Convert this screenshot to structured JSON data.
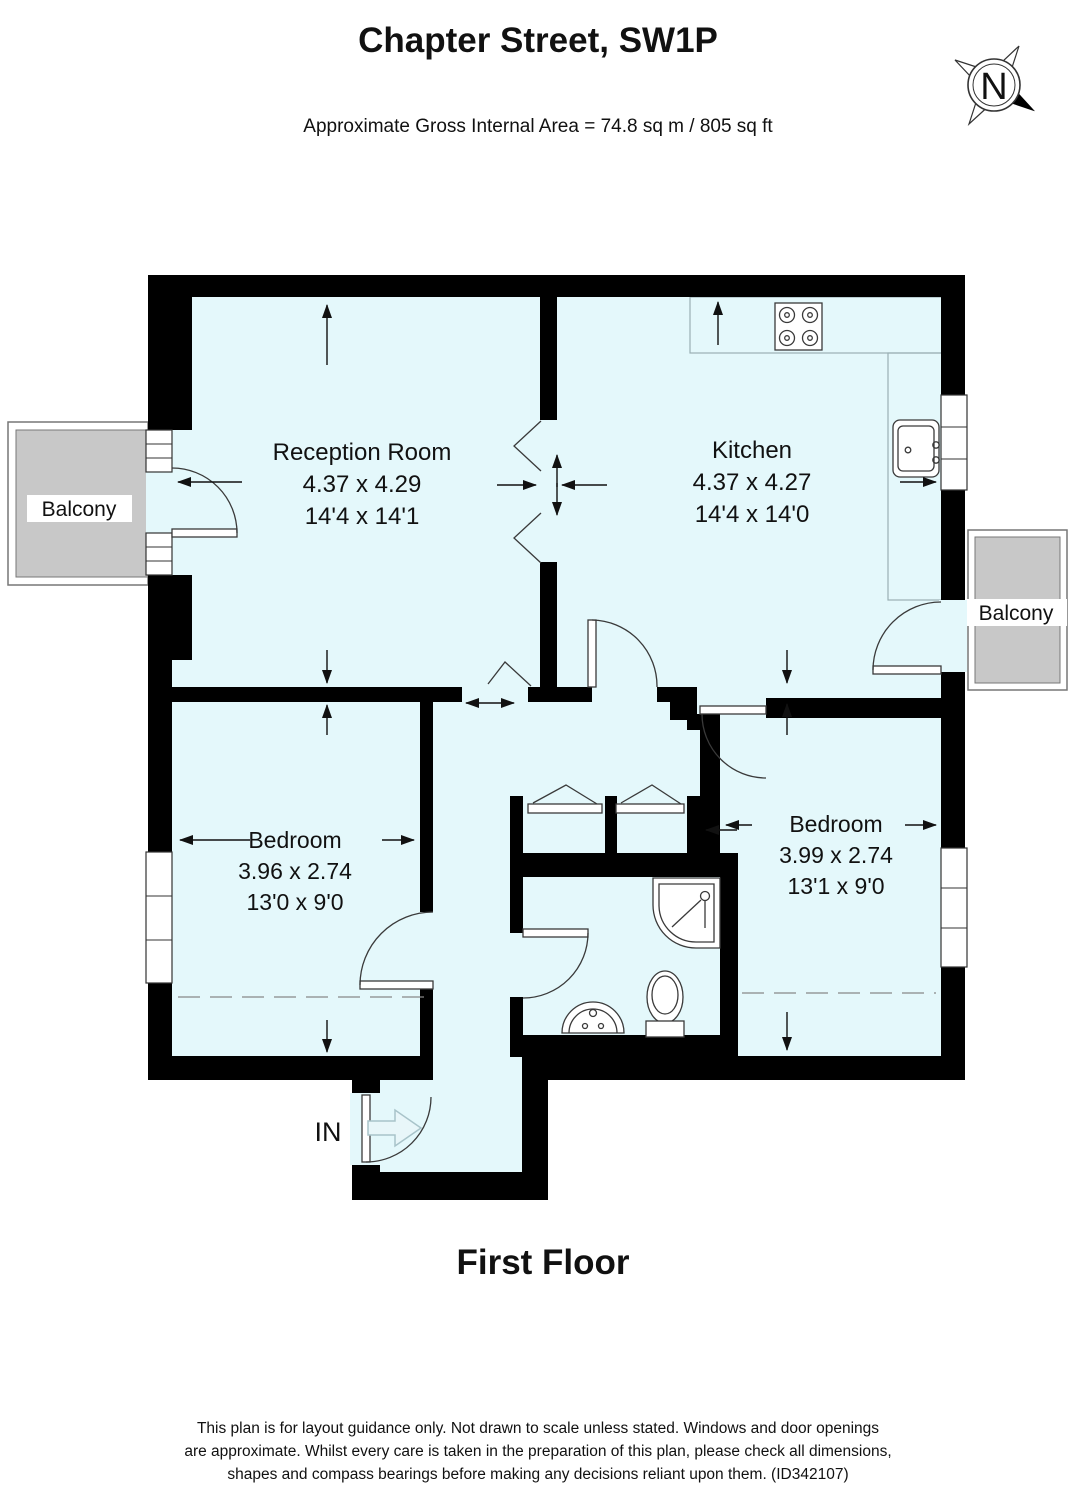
{
  "header": {
    "title": "Chapter Street, SW1P",
    "subtitle": "Approximate Gross Internal Area = 74.8 sq m / 805 sq ft"
  },
  "compass": {
    "label": "N"
  },
  "rooms": {
    "reception": {
      "name": "Reception Room",
      "dimensions_metric": "4.37 x 4.29",
      "dimensions_imperial": "14'4 x 14'1"
    },
    "kitchen": {
      "name": "Kitchen",
      "dimensions_metric": "4.37 x 4.27",
      "dimensions_imperial": "14'4 x 14'0"
    },
    "bedroom_left": {
      "name": "Bedroom",
      "dimensions_metric": "3.96 x 2.74",
      "dimensions_imperial": "13'0 x 9'0"
    },
    "bedroom_right": {
      "name": "Bedroom",
      "dimensions_metric": "3.99 x 2.74",
      "dimensions_imperial": "13'1 x 9'0"
    },
    "balcony_left": {
      "name": "Balcony"
    },
    "balcony_right": {
      "name": "Balcony"
    }
  },
  "entrance": {
    "label": "IN"
  },
  "floor": {
    "label": "First Floor"
  },
  "disclaimer": {
    "line1": "This plan is for layout guidance only. Not drawn to scale unless stated. Windows and door openings",
    "line2": "are approximate. Whilst every care is taken in the preparation of this plan, please check all dimensions,",
    "line3": "shapes and compass bearings before making any decisions reliant upon them. (ID342107)"
  },
  "colors": {
    "room_fill": "#e4f8fb",
    "balcony_fill": "#c8c8c8",
    "wall": "#000000"
  }
}
